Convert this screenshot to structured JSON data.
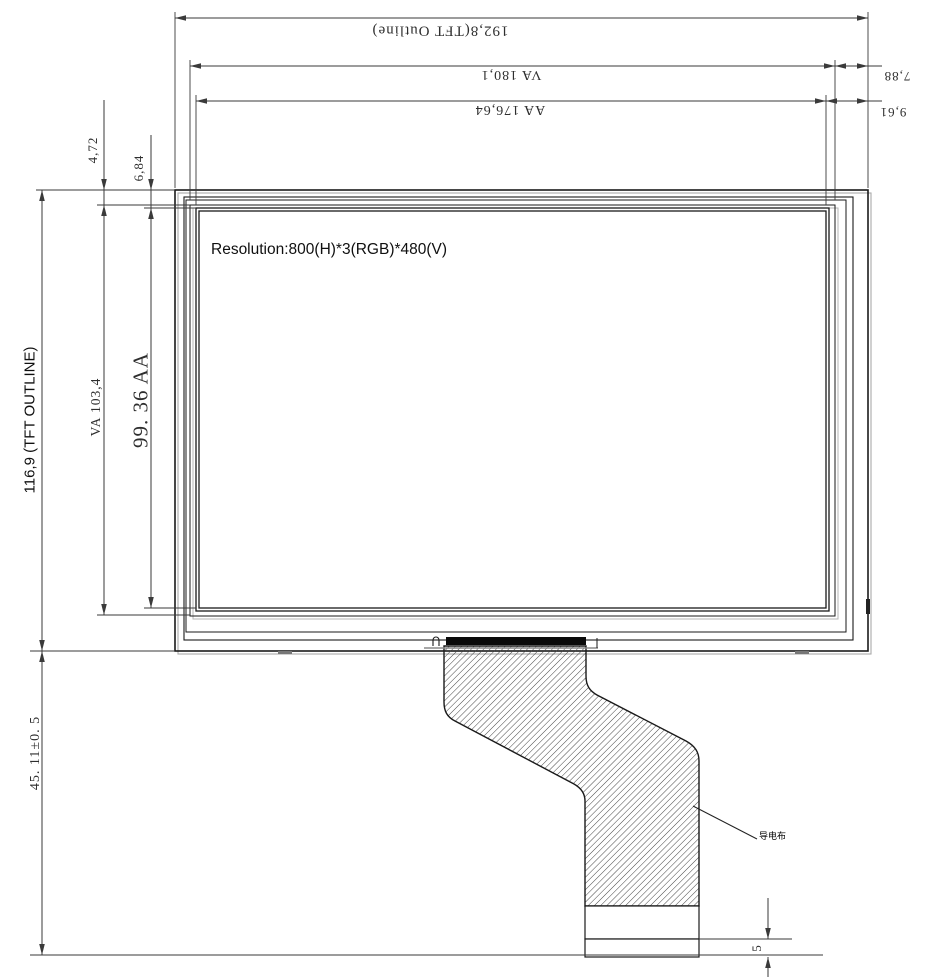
{
  "drawing": {
    "title": "TFT display module outline drawing",
    "colors": {
      "background": "#ffffff",
      "outline": "#1a1a1a",
      "dimension": "#3a3a3a",
      "shadow": "#aaaaaa",
      "hatch": "#444444",
      "connector_bar": "#0a0a0a"
    },
    "panel": {
      "resolution_label": "Resolution:800(H)*3(RGB)*480(V)"
    },
    "dimensions": {
      "tft_outline_width": "192,8(TFT Outline)",
      "va_width": "VA 180,1",
      "aa_width": "AA 176,64",
      "va_right_margin": "7,88",
      "aa_right_margin": "9,61",
      "va_top_margin": "4,72",
      "aa_top_margin": "6,84",
      "tft_outline_height": "116,9 (TFT OUTLINE)",
      "va_height": "VA 103,4",
      "aa_height": "99. 36 AA",
      "fpc_length": "45. 11±0. 5",
      "fpc_tail_height": "5"
    },
    "annotations": {
      "fpc_leader_label": "导电布"
    }
  }
}
